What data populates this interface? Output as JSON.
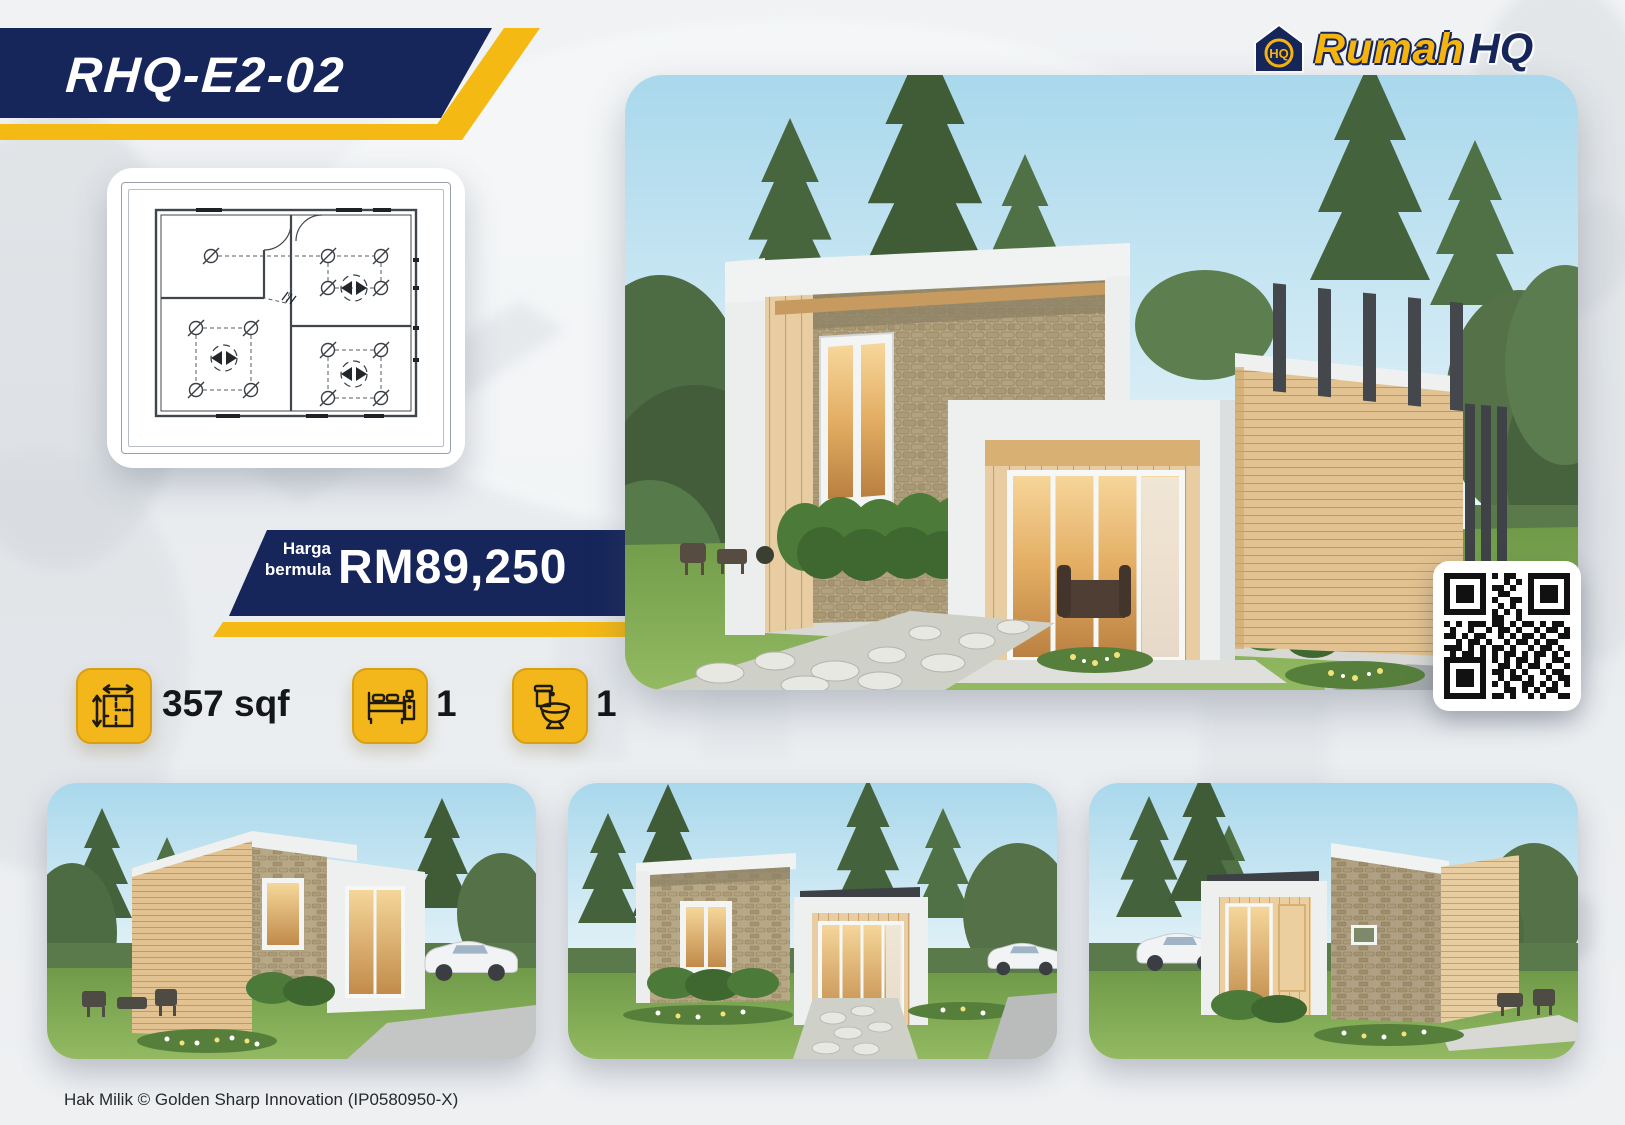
{
  "page": {
    "model_code": "RHQ-E2-02"
  },
  "brand": {
    "word1": "Rumah",
    "word2": "HQ",
    "monogram": "HQ"
  },
  "price": {
    "label_line1": "Harga",
    "label_line2": "bermula",
    "value": "RM89,250"
  },
  "specs": {
    "area": {
      "icon": "area-icon",
      "value": "357 sqf"
    },
    "bedrooms": {
      "icon": "bed-icon",
      "value": "1"
    },
    "bathrooms": {
      "icon": "toilet-icon",
      "value": "1"
    }
  },
  "footer": {
    "copyright": "Hak Milik © Golden Sharp Innovation (IP0580950-X)"
  },
  "colors": {
    "navy": "#16265b",
    "yellow": "#f5b914",
    "tile_yellow": "#f3b71b",
    "text_dark": "#14161a"
  },
  "qr": {
    "rows": [
      "111111101011001111111",
      "100000100010101000001",
      "101110101101001011101",
      "101110100110001011101",
      "101110101001101011101",
      "100000100101001000001",
      "111111101010101111111",
      "000000001100100000000",
      "101011101101011010110",
      "010010010110100101101",
      "110101100101011010011",
      "001011010010110101100",
      "111010101101001011010",
      "010110101011010110101",
      "111111101010110100110",
      "100000100110101101001",
      "101110101101010010110",
      "101110100101101001011",
      "101110101010011010101",
      "100000100011010101100",
      "111111101101001010011"
    ]
  }
}
